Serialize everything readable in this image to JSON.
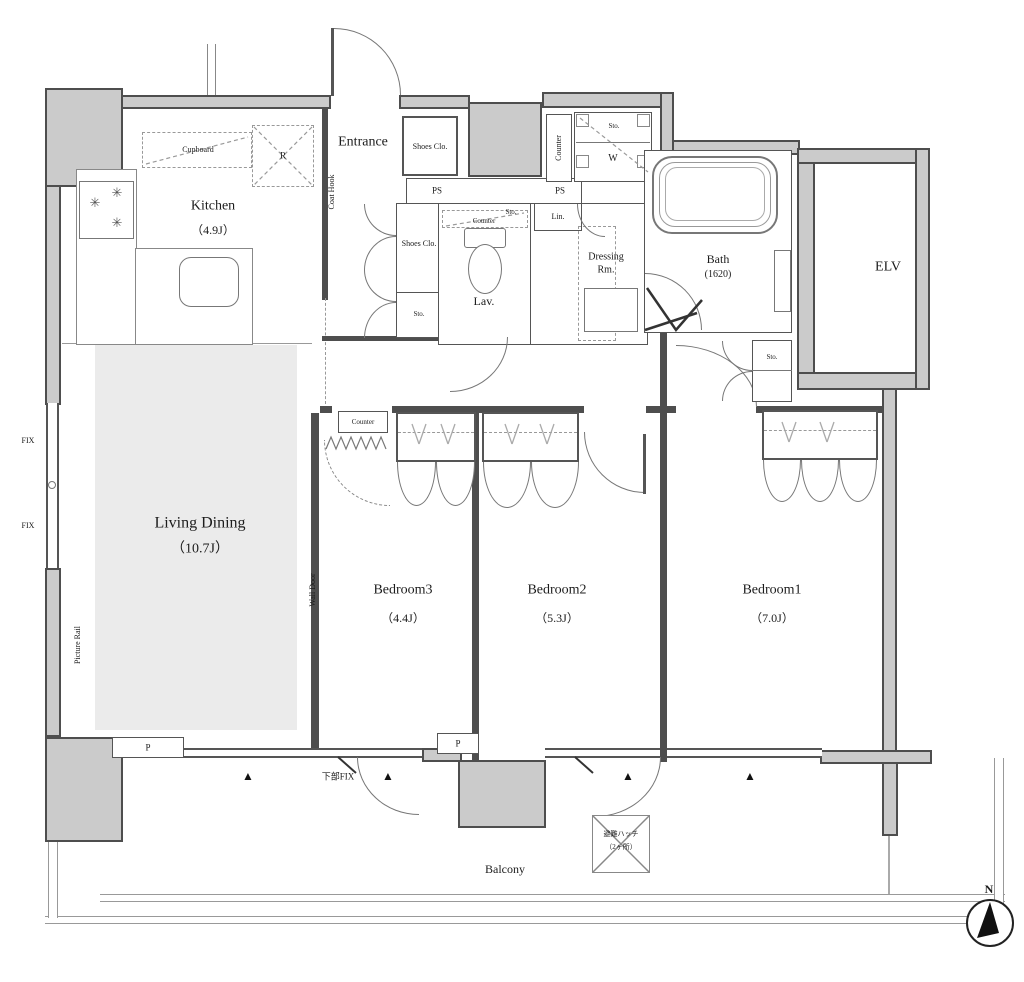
{
  "rooms": {
    "kitchen": {
      "label": "Kitchen",
      "size": "（4.9J）"
    },
    "living": {
      "label": "Living Dining",
      "size": "（10.7J）"
    },
    "bedroom1": {
      "label": "Bedroom1",
      "size": "（7.0J）"
    },
    "bedroom2": {
      "label": "Bedroom2",
      "size": "（5.3J）"
    },
    "bedroom3": {
      "label": "Bedroom3",
      "size": "（4.4J）"
    },
    "bath": {
      "label": "Bath",
      "size": "(1620)"
    },
    "lav": {
      "label": "Lav."
    },
    "dressing": {
      "line1": "Dressing",
      "line2": "Rm."
    },
    "entrance": {
      "label": "Entrance"
    },
    "elv": {
      "label": "ELV"
    },
    "balcony": {
      "label": "Balcony"
    }
  },
  "fixtures": {
    "cupboard": "Cupboard",
    "refrigerator": "R",
    "shoes_closet": "Shoes Clo.",
    "pipe_space": "PS",
    "storage": "Sto.",
    "linen": "Lin.",
    "counter": "Counter",
    "washer": "W",
    "coat_hook": "Coat Hook",
    "wall_door": "Wall Door",
    "picture_rail": "Picture Rail",
    "fixed_window": "FIX",
    "pillar": "P",
    "lower_fix": "下部FIX",
    "escape_hatch_line1": "避難ハッチ",
    "escape_hatch_line2": "（2ヶ所）"
  },
  "compass": {
    "north": "N"
  },
  "icons": {
    "window_marker": "▲",
    "burner": "✳"
  },
  "colors": {
    "wall_fill": "#cbcbcb",
    "wall_line": "#4e4e4e",
    "floor_gray": "#ebebeb"
  }
}
